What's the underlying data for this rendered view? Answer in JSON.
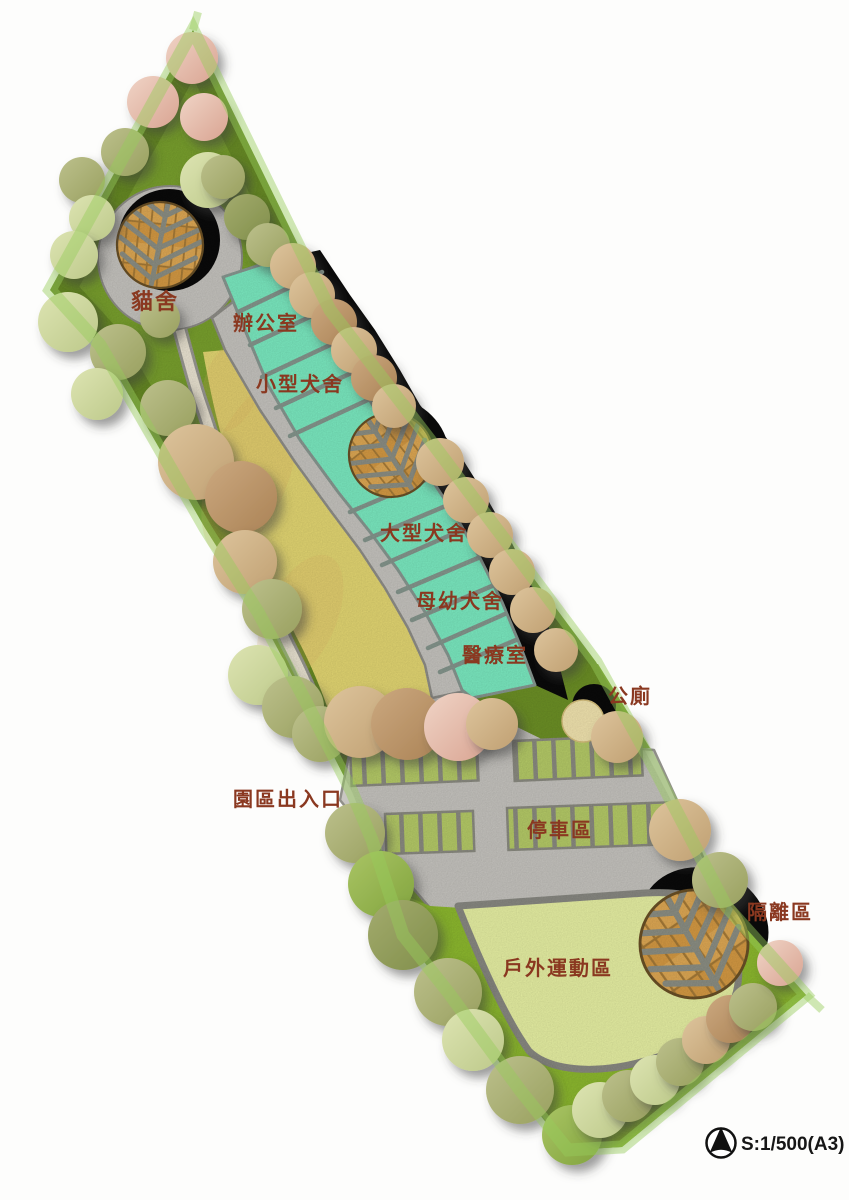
{
  "title": "動物收容園區配置圖",
  "labels": {
    "cat_house": "貓舍",
    "office": "辦公室",
    "small_dog_kennel": "小型犬舍",
    "large_dog_kennel": "大型犬舍",
    "mother_puppy_kennel": "母幼犬舍",
    "medical_room": "醫療室",
    "public_toilet": "公廁",
    "park_entrance": "園區出入口",
    "parking_area": "停車區",
    "isolation_area": "隔離區",
    "outdoor_exercise_area": "戶外運動區"
  },
  "legend": {
    "scale_text": "S:1/500(A3)",
    "north_arrow_icon": "north-arrow"
  },
  "colors": {
    "label_text": "#8a3820",
    "site_green": "#7ba32e",
    "edge_green": "#5a7a1e",
    "lawn_yellow": "#e7da74",
    "gravel_gray": "#c9c7c2",
    "gravel_edge": "#91908a",
    "path_cream": "#efe8d6",
    "path_edge": "#9b9a94",
    "building_teal": "#7deec4",
    "building_stripe": "#87988f",
    "stall_green": "#b8ce69",
    "divider_gray": "#8d8d83",
    "wood_orange": "#d89c44",
    "wood_light": "#e2ab55",
    "wood_seam": "#a87c38",
    "vein_gray": "#8e9186",
    "shadow_black": "#0a0a0a",
    "bottom_green": "#8fbc2f",
    "field_pale": "#ebf4a6",
    "field_edge": "#8b8b84",
    "toilet_yellow": "#f6e8b2",
    "knoll_green": "#6e9226",
    "boundary_glow": "rgba(150,205,90,0.45)"
  },
  "plan": {
    "tree_palette": {
      "pink": [
        "#f0d4c6",
        "#d9a492"
      ],
      "olive": [
        "#bcc08c",
        "#99a05f"
      ],
      "tan": [
        "#ddc49c",
        "#c0a072"
      ],
      "brownTan": [
        "#cba87f",
        "#ab8356"
      ],
      "paleGreen": [
        "#dde4b2",
        "#bdc98a"
      ],
      "green": [
        "#a9c464",
        "#82a43e"
      ],
      "darkOlive": [
        "#a3ab6e",
        "#818f4a"
      ]
    },
    "trees": [
      {
        "x": 192,
        "y": 58,
        "r": 26,
        "c": "pink"
      },
      {
        "x": 153,
        "y": 102,
        "r": 26,
        "c": "pink"
      },
      {
        "x": 204,
        "y": 117,
        "r": 24,
        "c": "pink"
      },
      {
        "x": 125,
        "y": 152,
        "r": 24,
        "c": "olive"
      },
      {
        "x": 82,
        "y": 180,
        "r": 23,
        "c": "olive"
      },
      {
        "x": 92,
        "y": 218,
        "r": 23,
        "c": "paleGreen"
      },
      {
        "x": 74,
        "y": 255,
        "r": 24,
        "c": "paleGreen"
      },
      {
        "x": 208,
        "y": 180,
        "r": 28,
        "c": "paleGreen"
      },
      {
        "x": 160,
        "y": 318,
        "r": 20,
        "c": "olive"
      },
      {
        "x": 68,
        "y": 322,
        "r": 30,
        "c": "paleGreen"
      },
      {
        "x": 118,
        "y": 352,
        "r": 28,
        "c": "olive"
      },
      {
        "x": 97,
        "y": 394,
        "r": 26,
        "c": "paleGreen"
      },
      {
        "x": 168,
        "y": 408,
        "r": 28,
        "c": "olive"
      },
      {
        "x": 196,
        "y": 462,
        "r": 38,
        "c": "tan"
      },
      {
        "x": 241,
        "y": 497,
        "r": 36,
        "c": "brownTan"
      },
      {
        "x": 245,
        "y": 562,
        "r": 32,
        "c": "tan"
      },
      {
        "x": 272,
        "y": 609,
        "r": 30,
        "c": "olive"
      },
      {
        "x": 258,
        "y": 675,
        "r": 30,
        "c": "paleGreen"
      },
      {
        "x": 293,
        "y": 707,
        "r": 31,
        "c": "olive"
      },
      {
        "x": 320,
        "y": 734,
        "r": 28,
        "c": "olive"
      },
      {
        "x": 360,
        "y": 722,
        "r": 36,
        "c": "tan"
      },
      {
        "x": 407,
        "y": 724,
        "r": 36,
        "c": "brownTan"
      },
      {
        "x": 458,
        "y": 727,
        "r": 34,
        "c": "pink"
      },
      {
        "x": 492,
        "y": 724,
        "r": 26,
        "c": "tan"
      },
      {
        "x": 355,
        "y": 833,
        "r": 30,
        "c": "olive"
      },
      {
        "x": 381,
        "y": 884,
        "r": 33,
        "c": "green"
      },
      {
        "x": 403,
        "y": 935,
        "r": 35,
        "c": "darkOlive"
      },
      {
        "x": 448,
        "y": 992,
        "r": 34,
        "c": "olive"
      },
      {
        "x": 473,
        "y": 1040,
        "r": 31,
        "c": "paleGreen"
      },
      {
        "x": 520,
        "y": 1090,
        "r": 34,
        "c": "olive"
      },
      {
        "x": 572,
        "y": 1135,
        "r": 30,
        "c": "green"
      },
      {
        "x": 600,
        "y": 1110,
        "r": 28,
        "c": "paleGreen"
      },
      {
        "x": 628,
        "y": 1096,
        "r": 26,
        "c": "olive"
      },
      {
        "x": 655,
        "y": 1080,
        "r": 25,
        "c": "paleGreen"
      },
      {
        "x": 680,
        "y": 1062,
        "r": 24,
        "c": "olive"
      },
      {
        "x": 706,
        "y": 1040,
        "r": 24,
        "c": "tan"
      },
      {
        "x": 730,
        "y": 1019,
        "r": 24,
        "c": "brownTan"
      },
      {
        "x": 753,
        "y": 1007,
        "r": 24,
        "c": "olive"
      },
      {
        "x": 780,
        "y": 963,
        "r": 23,
        "c": "pink"
      },
      {
        "x": 223,
        "y": 177,
        "r": 22,
        "c": "olive"
      },
      {
        "x": 247,
        "y": 217,
        "r": 23,
        "c": "darkOlive"
      },
      {
        "x": 268,
        "y": 245,
        "r": 22,
        "c": "olive"
      },
      {
        "x": 293,
        "y": 266,
        "r": 23,
        "c": "tan"
      },
      {
        "x": 312,
        "y": 295,
        "r": 23,
        "c": "tan"
      },
      {
        "x": 334,
        "y": 322,
        "r": 23,
        "c": "brownTan"
      },
      {
        "x": 354,
        "y": 350,
        "r": 23,
        "c": "tan"
      },
      {
        "x": 374,
        "y": 378,
        "r": 23,
        "c": "brownTan"
      },
      {
        "x": 394,
        "y": 406,
        "r": 22,
        "c": "tan"
      },
      {
        "x": 440,
        "y": 462,
        "r": 24,
        "c": "tan"
      },
      {
        "x": 466,
        "y": 500,
        "r": 23,
        "c": "tan"
      },
      {
        "x": 490,
        "y": 535,
        "r": 23,
        "c": "tan"
      },
      {
        "x": 512,
        "y": 572,
        "r": 23,
        "c": "tan"
      },
      {
        "x": 533,
        "y": 610,
        "r": 23,
        "c": "tan"
      },
      {
        "x": 556,
        "y": 650,
        "r": 22,
        "c": "tan"
      },
      {
        "x": 617,
        "y": 737,
        "r": 26,
        "c": "tan"
      },
      {
        "x": 680,
        "y": 830,
        "r": 31,
        "c": "tan"
      },
      {
        "x": 720,
        "y": 880,
        "r": 28,
        "c": "olive"
      }
    ]
  }
}
